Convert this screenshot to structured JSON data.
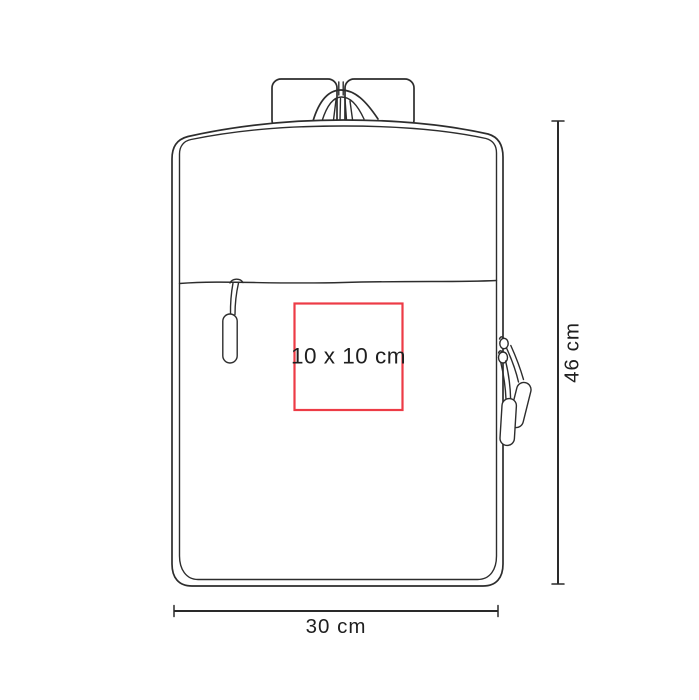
{
  "diagram": {
    "type": "product-print-area-diagram",
    "background": "#ffffff",
    "line_color": "#2d2d2d",
    "text_color": "#1f1f1f",
    "print_area": {
      "label": "10 x 10 cm",
      "border_color": "#ed3b46"
    },
    "dimensions": {
      "height_label": "46 cm",
      "width_label": "30 cm"
    }
  }
}
